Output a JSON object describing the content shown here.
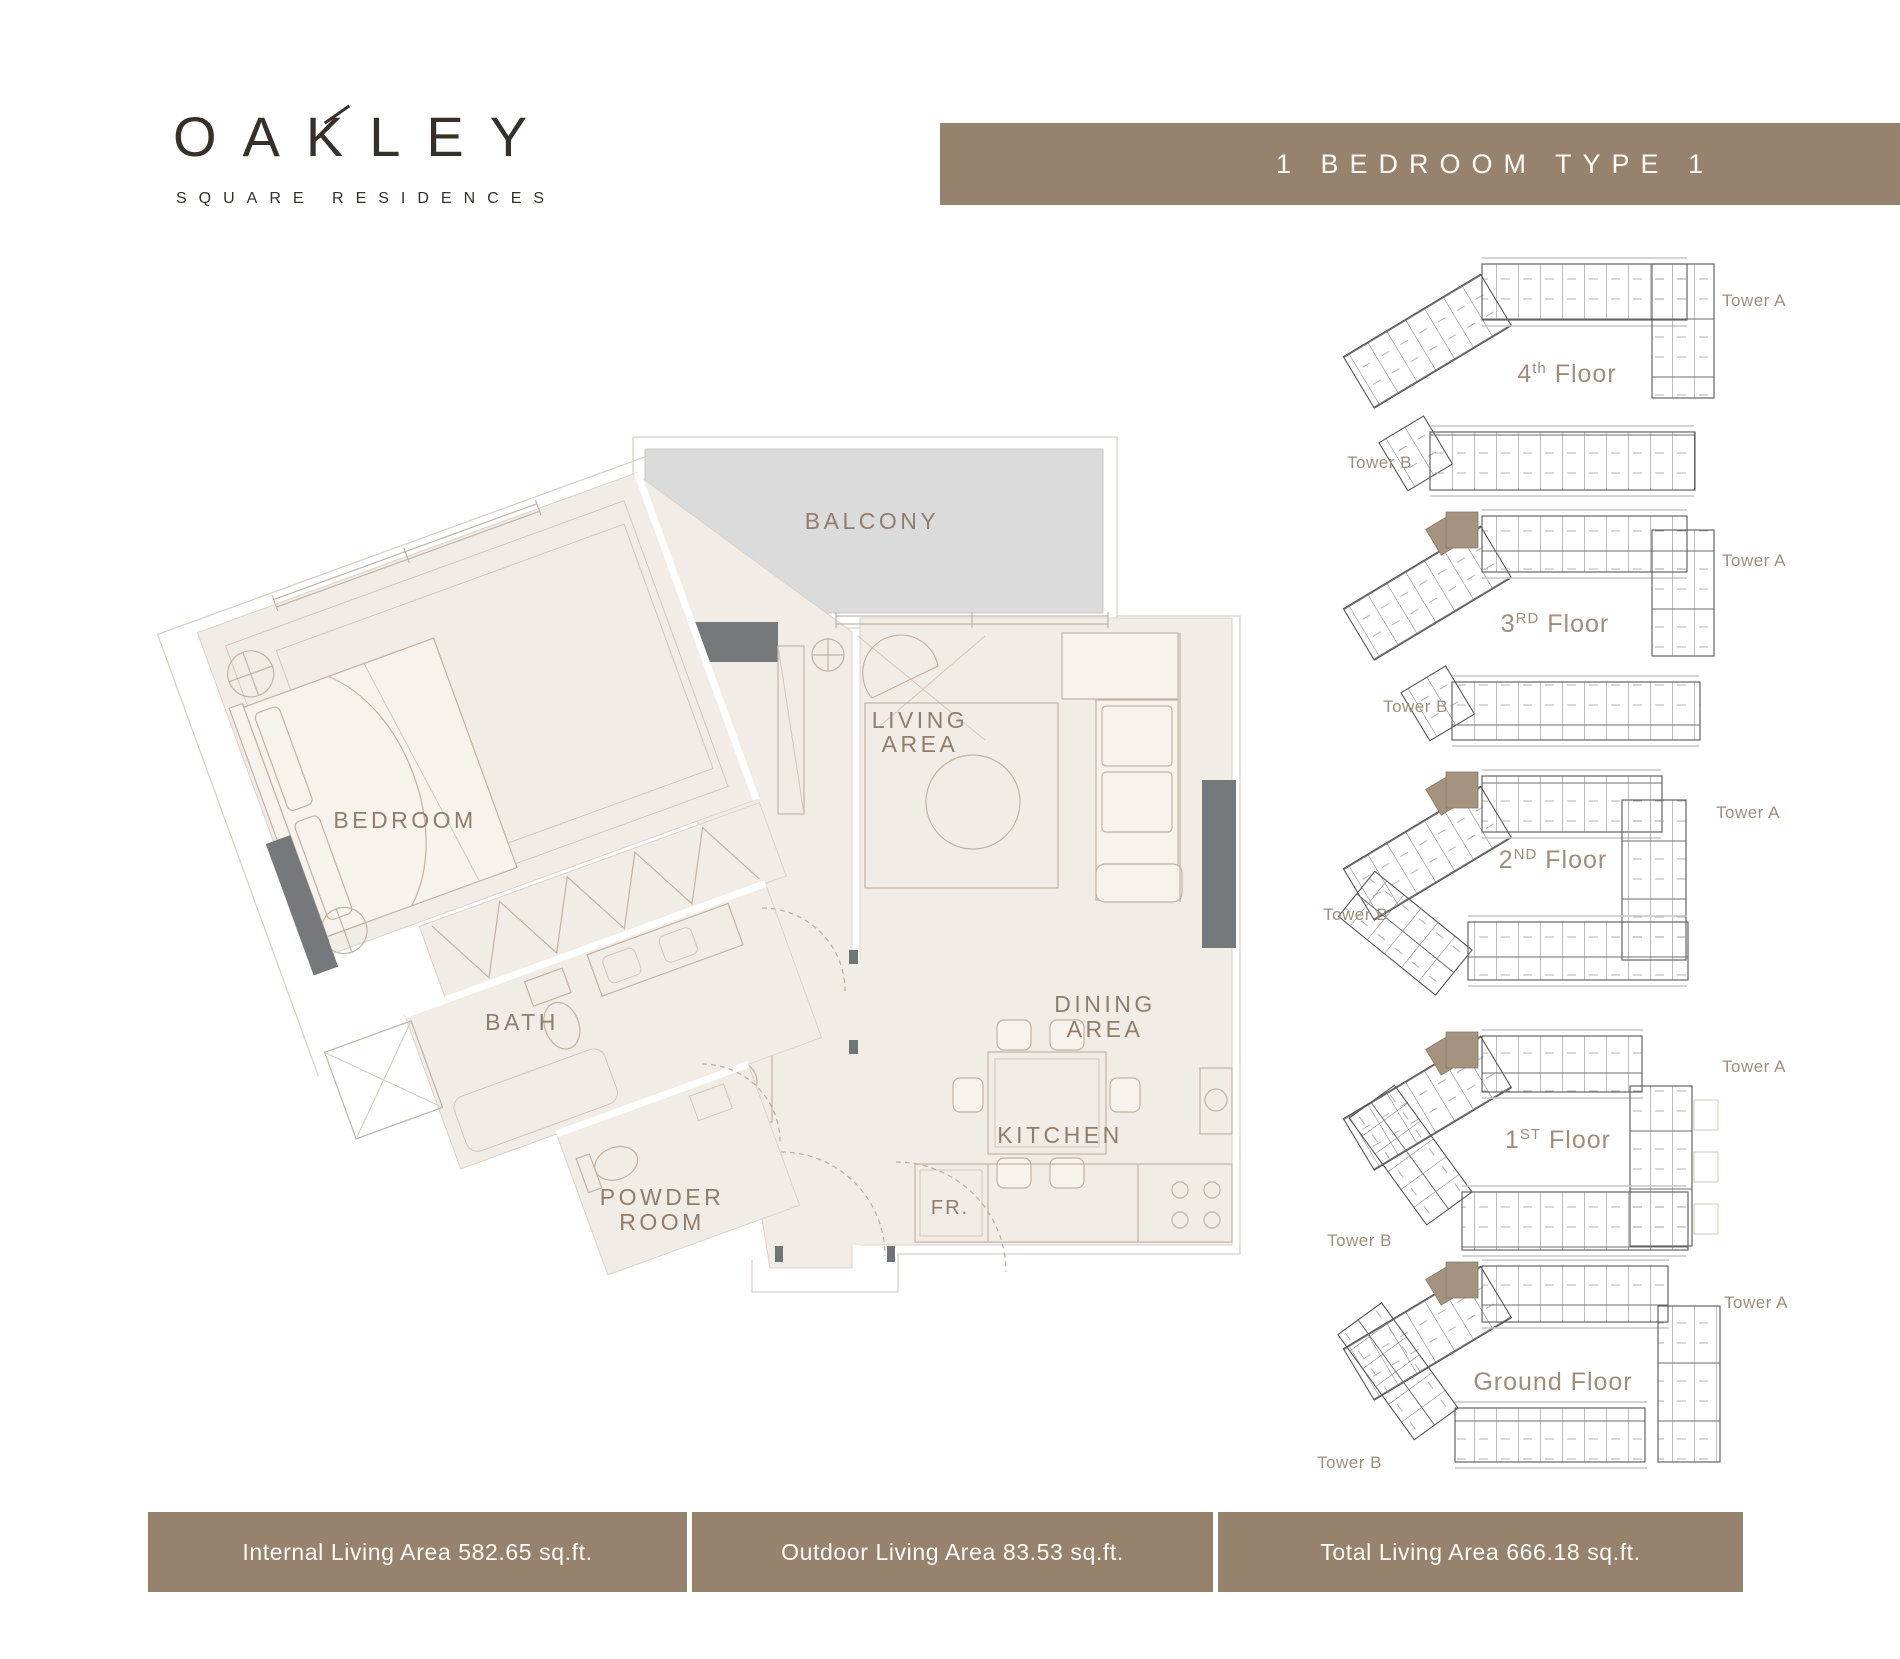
{
  "colors": {
    "brand_brown": "#97826e",
    "highlight_taupe": "#a6937f",
    "balcony_gray": "#dadbda",
    "room_beige": "#f2ece6",
    "label_brown": "#8f7e6d",
    "locator_brown": "#a18d79",
    "wall_dark": "#75797c",
    "logo_ink": "#35302a"
  },
  "logo": {
    "title": "OAKLEY",
    "subtitle": "SQUARE RESIDENCES"
  },
  "banner": {
    "title": "1 BEDROOM TYPE 1"
  },
  "floorplan": {
    "labels": {
      "balcony": "BALCONY",
      "living_1": "LIVING",
      "living_2": "AREA",
      "bedroom": "BEDROOM",
      "bath": "BATH",
      "powder_1": "POWDER",
      "powder_2": "ROOM",
      "dining_1": "DINING",
      "dining_2": "AREA",
      "kitchen": "KITCHEN",
      "fridge": "FR."
    }
  },
  "floor_locator": {
    "tower_a": "Tower A",
    "tower_b": "Tower B",
    "floors": [
      {
        "num": "4",
        "sup": "th",
        "word": " Floor"
      },
      {
        "num": "3",
        "sup": "RD",
        "word": " Floor"
      },
      {
        "num": "2",
        "sup": "ND",
        "word": " Floor"
      },
      {
        "num": "1",
        "sup": "ST",
        "word": " Floor"
      },
      {
        "num": "",
        "sup": "",
        "word": "Ground Floor"
      }
    ]
  },
  "footer": {
    "stats": [
      {
        "label": "Internal Living Area 582.65 sq.ft."
      },
      {
        "label": "Outdoor Living Area 83.53 sq.ft."
      },
      {
        "label": "Total Living Area 666.18 sq.ft."
      }
    ]
  }
}
